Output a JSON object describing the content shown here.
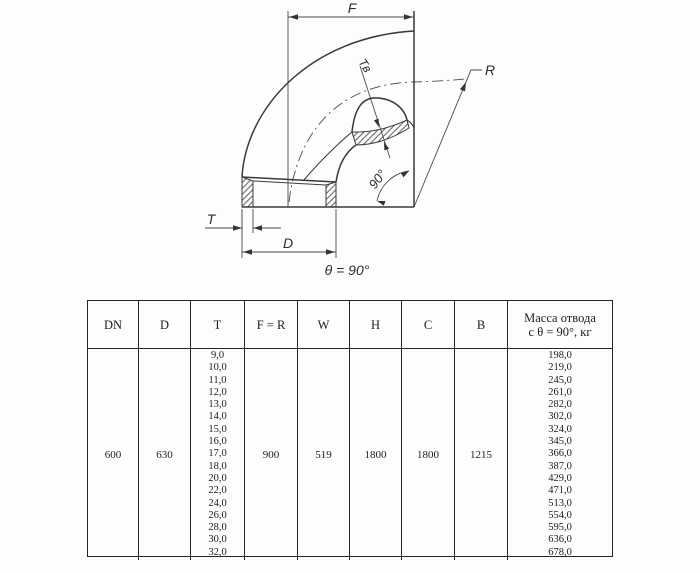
{
  "document": {
    "drawing": {
      "dim_f": "F",
      "dim_r": "R",
      "dim_t": "T",
      "dim_d": "D",
      "dim_tv": "Tв",
      "angle_arc": "90°",
      "caption": "θ = 90°"
    },
    "table": {
      "headers": [
        "DN",
        "D",
        "T",
        "F = R",
        "W",
        "H",
        "C",
        "B",
        [
          "Масса отвода",
          "с θ = 90°, кг"
        ]
      ],
      "row": {
        "dn": "600",
        "d": "630",
        "t": [
          "9,0",
          "10,0",
          "11,0",
          "12,0",
          "13,0",
          "14,0",
          "15,0",
          "16,0",
          "17,0",
          "18,0",
          "20,0",
          "22,0",
          "24,0",
          "26,0",
          "28,0",
          "30,0",
          "32,0"
        ],
        "f_r": "900",
        "w": "519",
        "h": "1800",
        "c": "1800",
        "b": "1215",
        "mass": [
          "198,0",
          "219,0",
          "245,0",
          "261,0",
          "282,0",
          "302,0",
          "324,0",
          "345,0",
          "366,0",
          "387,0",
          "429,0",
          "471,0",
          "513,0",
          "554,0",
          "595,0",
          "636,0",
          "678,0"
        ]
      }
    }
  }
}
